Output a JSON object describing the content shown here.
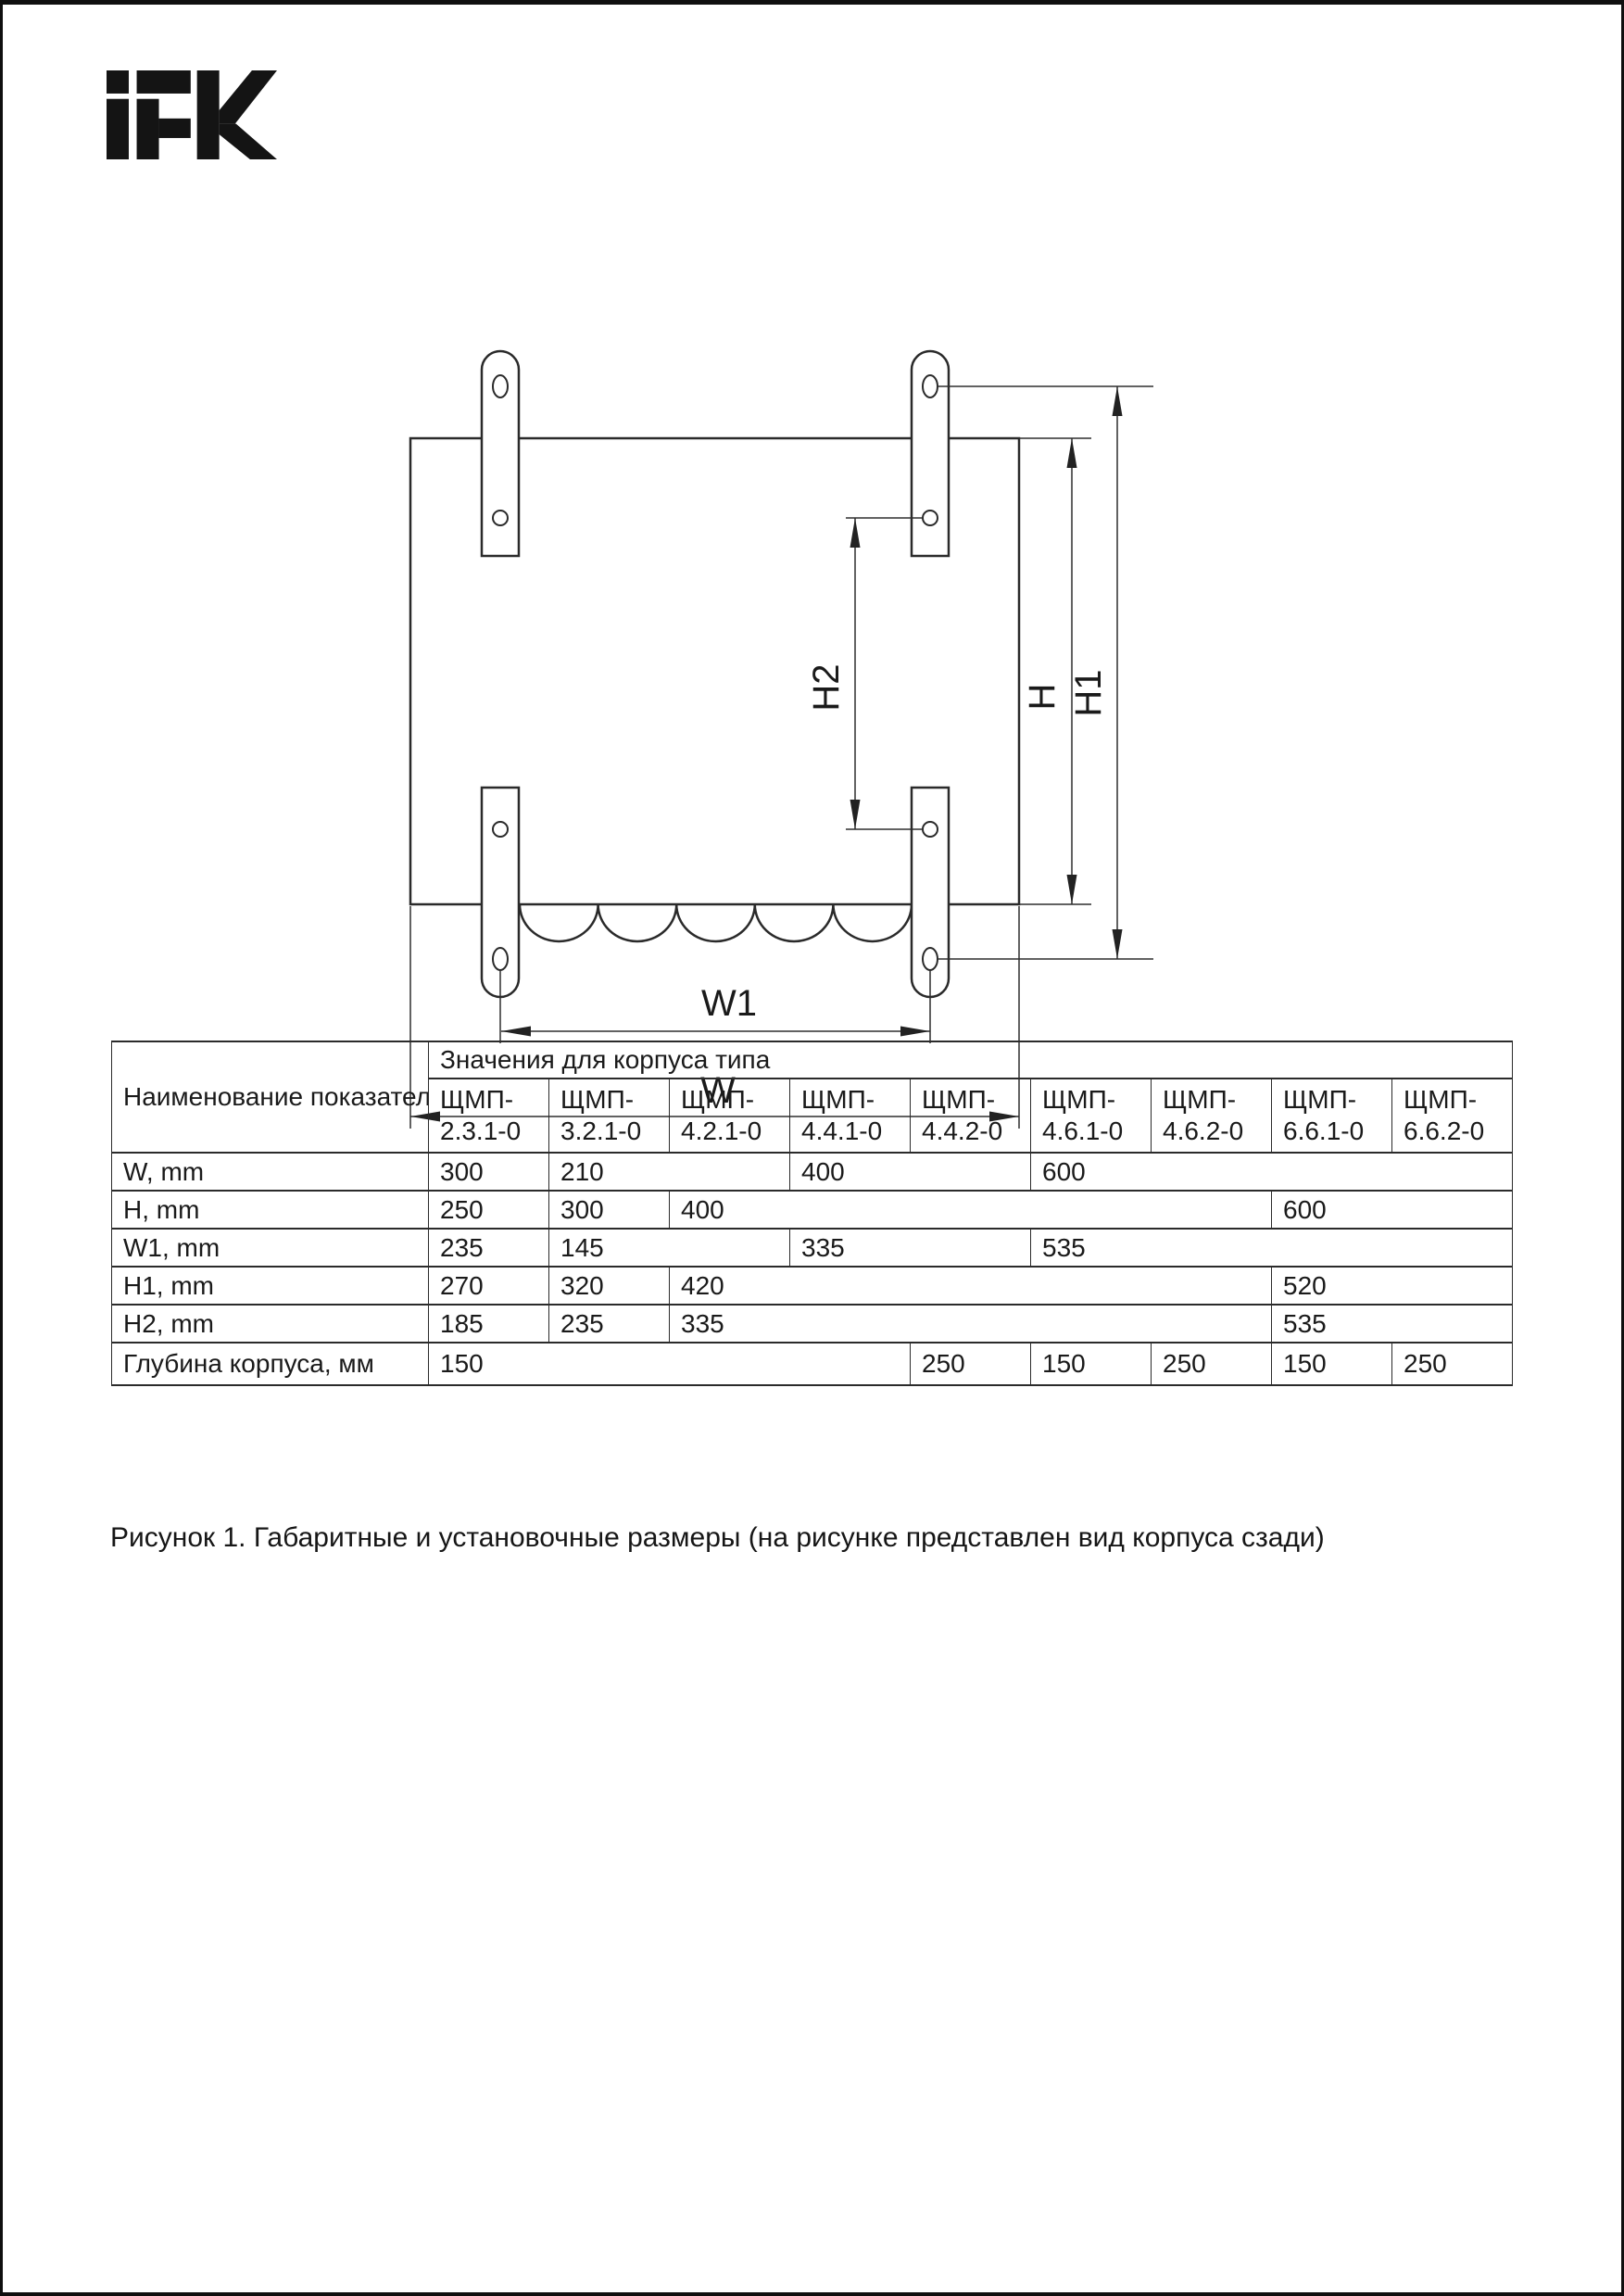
{
  "colors": {
    "ink": "#1a1a1a",
    "line": "#2b2b2b",
    "page_bg": "#ffffff",
    "frame": "#0f0f0f"
  },
  "logo": {
    "text": "IEK"
  },
  "drawing": {
    "labels": {
      "h2": "H2",
      "h": "H",
      "h1": "H1",
      "w1": "W1",
      "w": "W"
    }
  },
  "table": {
    "header": {
      "name_col": "Наименование показателя",
      "values_col": "Значения для корпуса типа"
    },
    "columns": [
      {
        "prefix": "ЩМП-",
        "code": "2.3.1-0"
      },
      {
        "prefix": "ЩМП-",
        "code": "3.2.1-0"
      },
      {
        "prefix": "ЩМП-",
        "code": "4.2.1-0"
      },
      {
        "prefix": "ЩМП-",
        "code": "4.4.1-0"
      },
      {
        "prefix": "ЩМП-",
        "code": "4.4.2-0"
      },
      {
        "prefix": "ЩМП-",
        "code": "4.6.1-0"
      },
      {
        "prefix": "ЩМП-",
        "code": "4.6.2-0"
      },
      {
        "prefix": "ЩМП-",
        "code": "6.6.1-0"
      },
      {
        "prefix": "ЩМП-",
        "code": "6.6.2-0"
      }
    ],
    "rows": [
      {
        "label": "W, mm",
        "cells": [
          {
            "v": "300",
            "span": 1
          },
          {
            "v": "210",
            "span": 2
          },
          {
            "v": "400",
            "span": 2
          },
          {
            "v": "600",
            "span": 4
          }
        ]
      },
      {
        "label": "H, mm",
        "cells": [
          {
            "v": "250",
            "span": 1
          },
          {
            "v": "300",
            "span": 1
          },
          {
            "v": "400",
            "span": 5
          },
          {
            "v": "600",
            "span": 2
          }
        ]
      },
      {
        "label": "W1, mm",
        "cells": [
          {
            "v": "235",
            "span": 1
          },
          {
            "v": "145",
            "span": 2
          },
          {
            "v": "335",
            "span": 2
          },
          {
            "v": "535",
            "span": 4
          }
        ]
      },
      {
        "label": "H1, mm",
        "cells": [
          {
            "v": "270",
            "span": 1
          },
          {
            "v": "320",
            "span": 1
          },
          {
            "v": "420",
            "span": 5
          },
          {
            "v": "520",
            "span": 2
          }
        ]
      },
      {
        "label": "H2, mm",
        "cells": [
          {
            "v": "185",
            "span": 1
          },
          {
            "v": "235",
            "span": 1
          },
          {
            "v": "335",
            "span": 5
          },
          {
            "v": "535",
            "span": 2
          }
        ]
      },
      {
        "label": "Глубина корпуса, мм",
        "cells": [
          {
            "v": "150",
            "span": 4
          },
          {
            "v": "250",
            "span": 1
          },
          {
            "v": "150",
            "span": 1
          },
          {
            "v": "250",
            "span": 1
          },
          {
            "v": "150",
            "span": 1
          },
          {
            "v": "250",
            "span": 1
          }
        ]
      }
    ]
  },
  "caption": "Рисунок 1. Габаритные и установочные размеры (на рисунке представлен вид корпуса сзади)"
}
